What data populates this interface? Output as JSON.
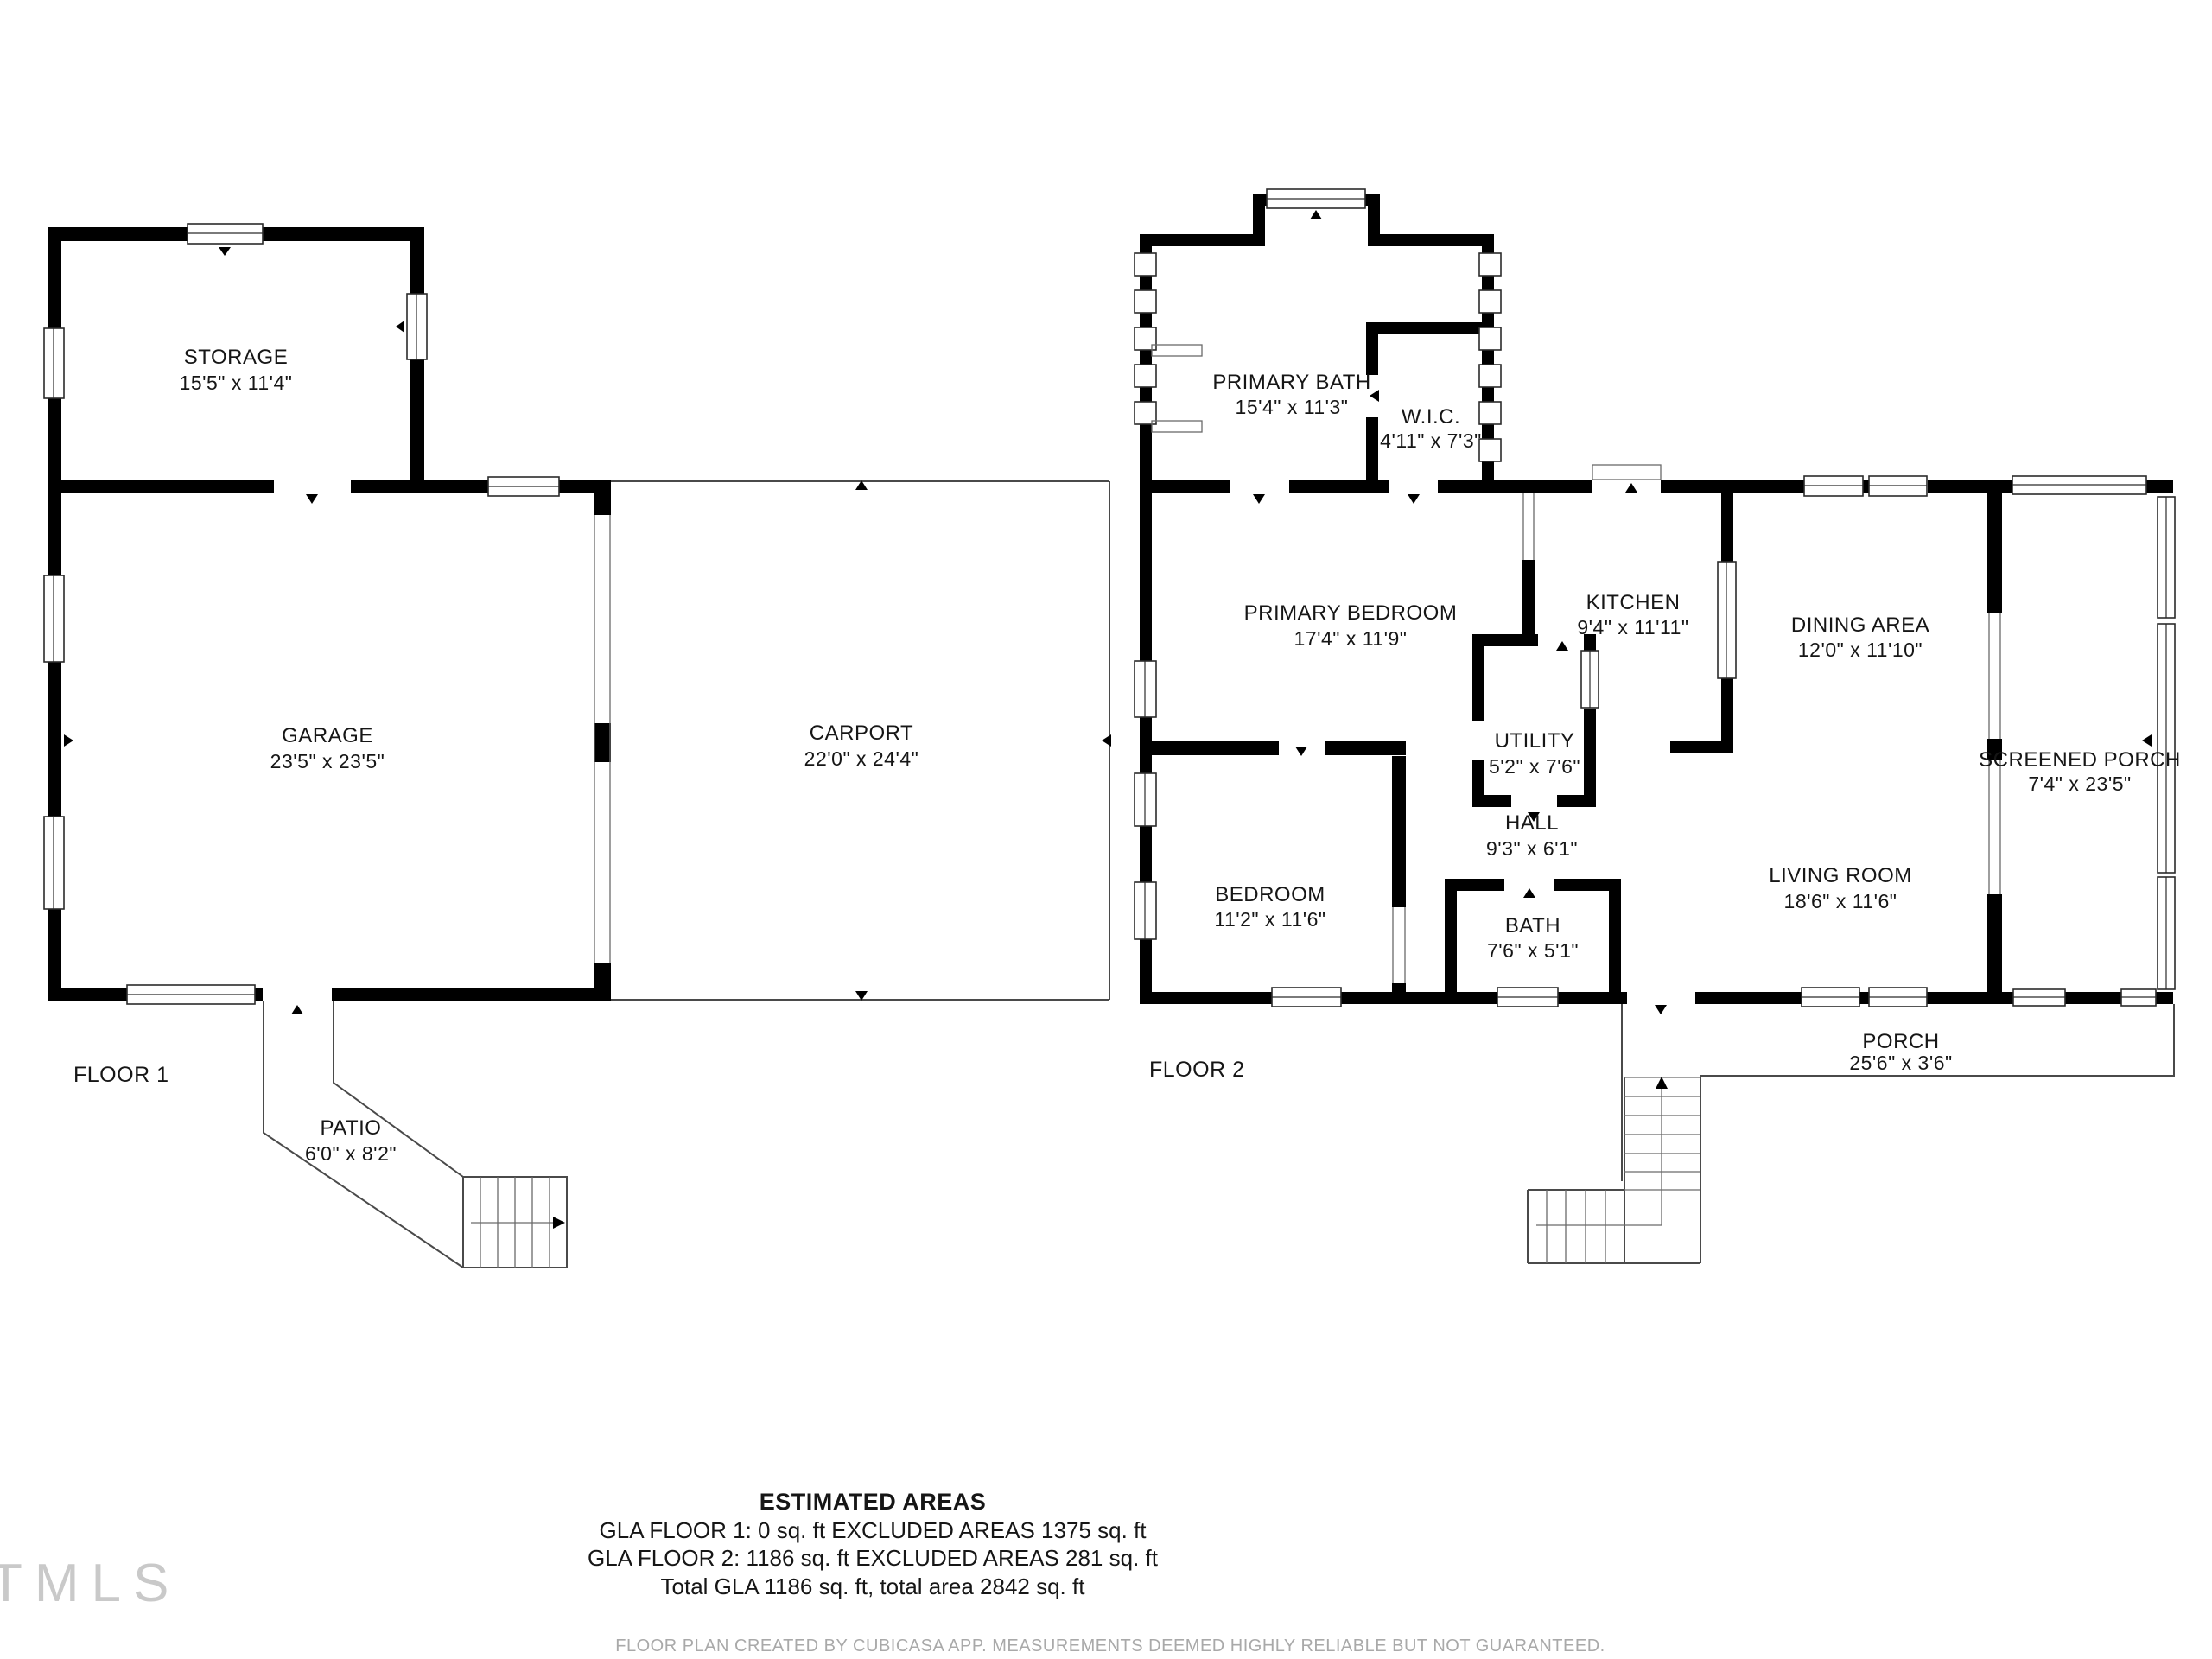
{
  "floor1": {
    "label": "FLOOR 1",
    "rooms": {
      "storage": {
        "name": "STORAGE",
        "dims": "15'5\" x 11'4\""
      },
      "garage": {
        "name": "GARAGE",
        "dims": "23'5\" x 23'5\""
      },
      "carport": {
        "name": "CARPORT",
        "dims": "22'0\" x 24'4\""
      },
      "patio": {
        "name": "PATIO",
        "dims": "6'0\" x 8'2\""
      }
    }
  },
  "floor2": {
    "label": "FLOOR 2",
    "rooms": {
      "primary_bath": {
        "name": "PRIMARY BATH",
        "dims": "15'4\" x 11'3\""
      },
      "wic": {
        "name": "W.I.C.",
        "dims": "4'11\" x 7'3\""
      },
      "primary_bedroom": {
        "name": "PRIMARY BEDROOM",
        "dims": "17'4\" x 11'9\""
      },
      "kitchen": {
        "name": "KITCHEN",
        "dims": "9'4\" x 11'11\""
      },
      "dining_area": {
        "name": "DINING AREA",
        "dims": "12'0\" x 11'10\""
      },
      "utility": {
        "name": "UTILITY",
        "dims": "5'2\" x 7'6\""
      },
      "hall": {
        "name": "HALL",
        "dims": "9'3\" x 6'1\""
      },
      "bedroom": {
        "name": "BEDROOM",
        "dims": "11'2\" x 11'6\""
      },
      "bath": {
        "name": "BATH",
        "dims": "7'6\" x 5'1\""
      },
      "living_room": {
        "name": "LIVING ROOM",
        "dims": "18'6\" x 11'6\""
      },
      "screened_porch": {
        "name": "SCREENED PORCH",
        "dims": "7'4\" x 23'5\""
      },
      "porch": {
        "name": "PORCH",
        "dims": "25'6\" x 3'6\""
      }
    }
  },
  "summary": {
    "title": "ESTIMATED AREAS",
    "line1": "GLA FLOOR 1: 0 sq. ft EXCLUDED AREAS 1375 sq. ft",
    "line2": "GLA FLOOR 2: 1186 sq. ft EXCLUDED AREAS 281 sq. ft",
    "line3": "Total GLA 1186 sq. ft, total area 2842 sq. ft"
  },
  "footer": {
    "disclaimer": "FLOOR PLAN CREATED BY CUBICASA APP. MEASUREMENTS DEEMED HIGHLY RELIABLE BUT NOT GUARANTEED."
  },
  "watermark": {
    "text": "TMLS"
  }
}
